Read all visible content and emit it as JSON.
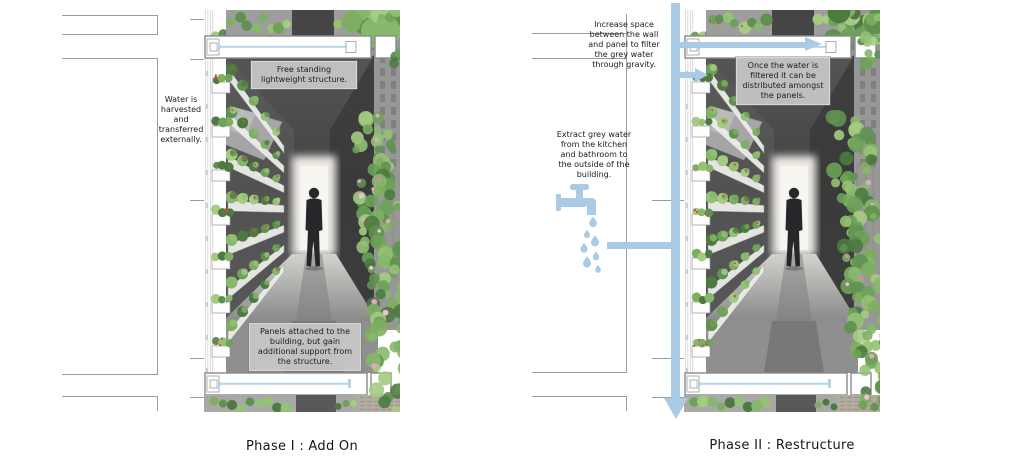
{
  "colors": {
    "arrow_blue": "#a9cbe6",
    "pipe_blue": "#b7d3e8",
    "annotation_box_bg": "#c7c7c7",
    "text_dark": "#1c1c22"
  },
  "left_figure": {
    "caption": "Phase I : Add On",
    "label_water_harvested": "Water is\nharvested\nand\ntransferred\nexternally.",
    "box_free_standing": "Free standing\nlightweight structure.",
    "box_panels_attached": "Panels attached to the\nbuilding, but gain\nadditional support from\nthe structure."
  },
  "right_figure": {
    "caption": "Phase II : Restructure",
    "label_increase_space": "Increase space\nbetween the wall\nand panel to filter\nthe grey water\nthrough gravity.",
    "label_extract_grey_water": "Extract grey water\nfrom the kitchen\nand bathroom to\nthe outside of the\nbuilding.",
    "box_once_filtered": "Once the water is\nfiltered it can be\ndistributed amongst\nthe panels."
  },
  "icons": {
    "faucet": "faucet-icon",
    "water_drops": "water-drops-icon",
    "down_arrow": "down-arrow-icon",
    "right_arrow": "right-arrow-icon"
  }
}
